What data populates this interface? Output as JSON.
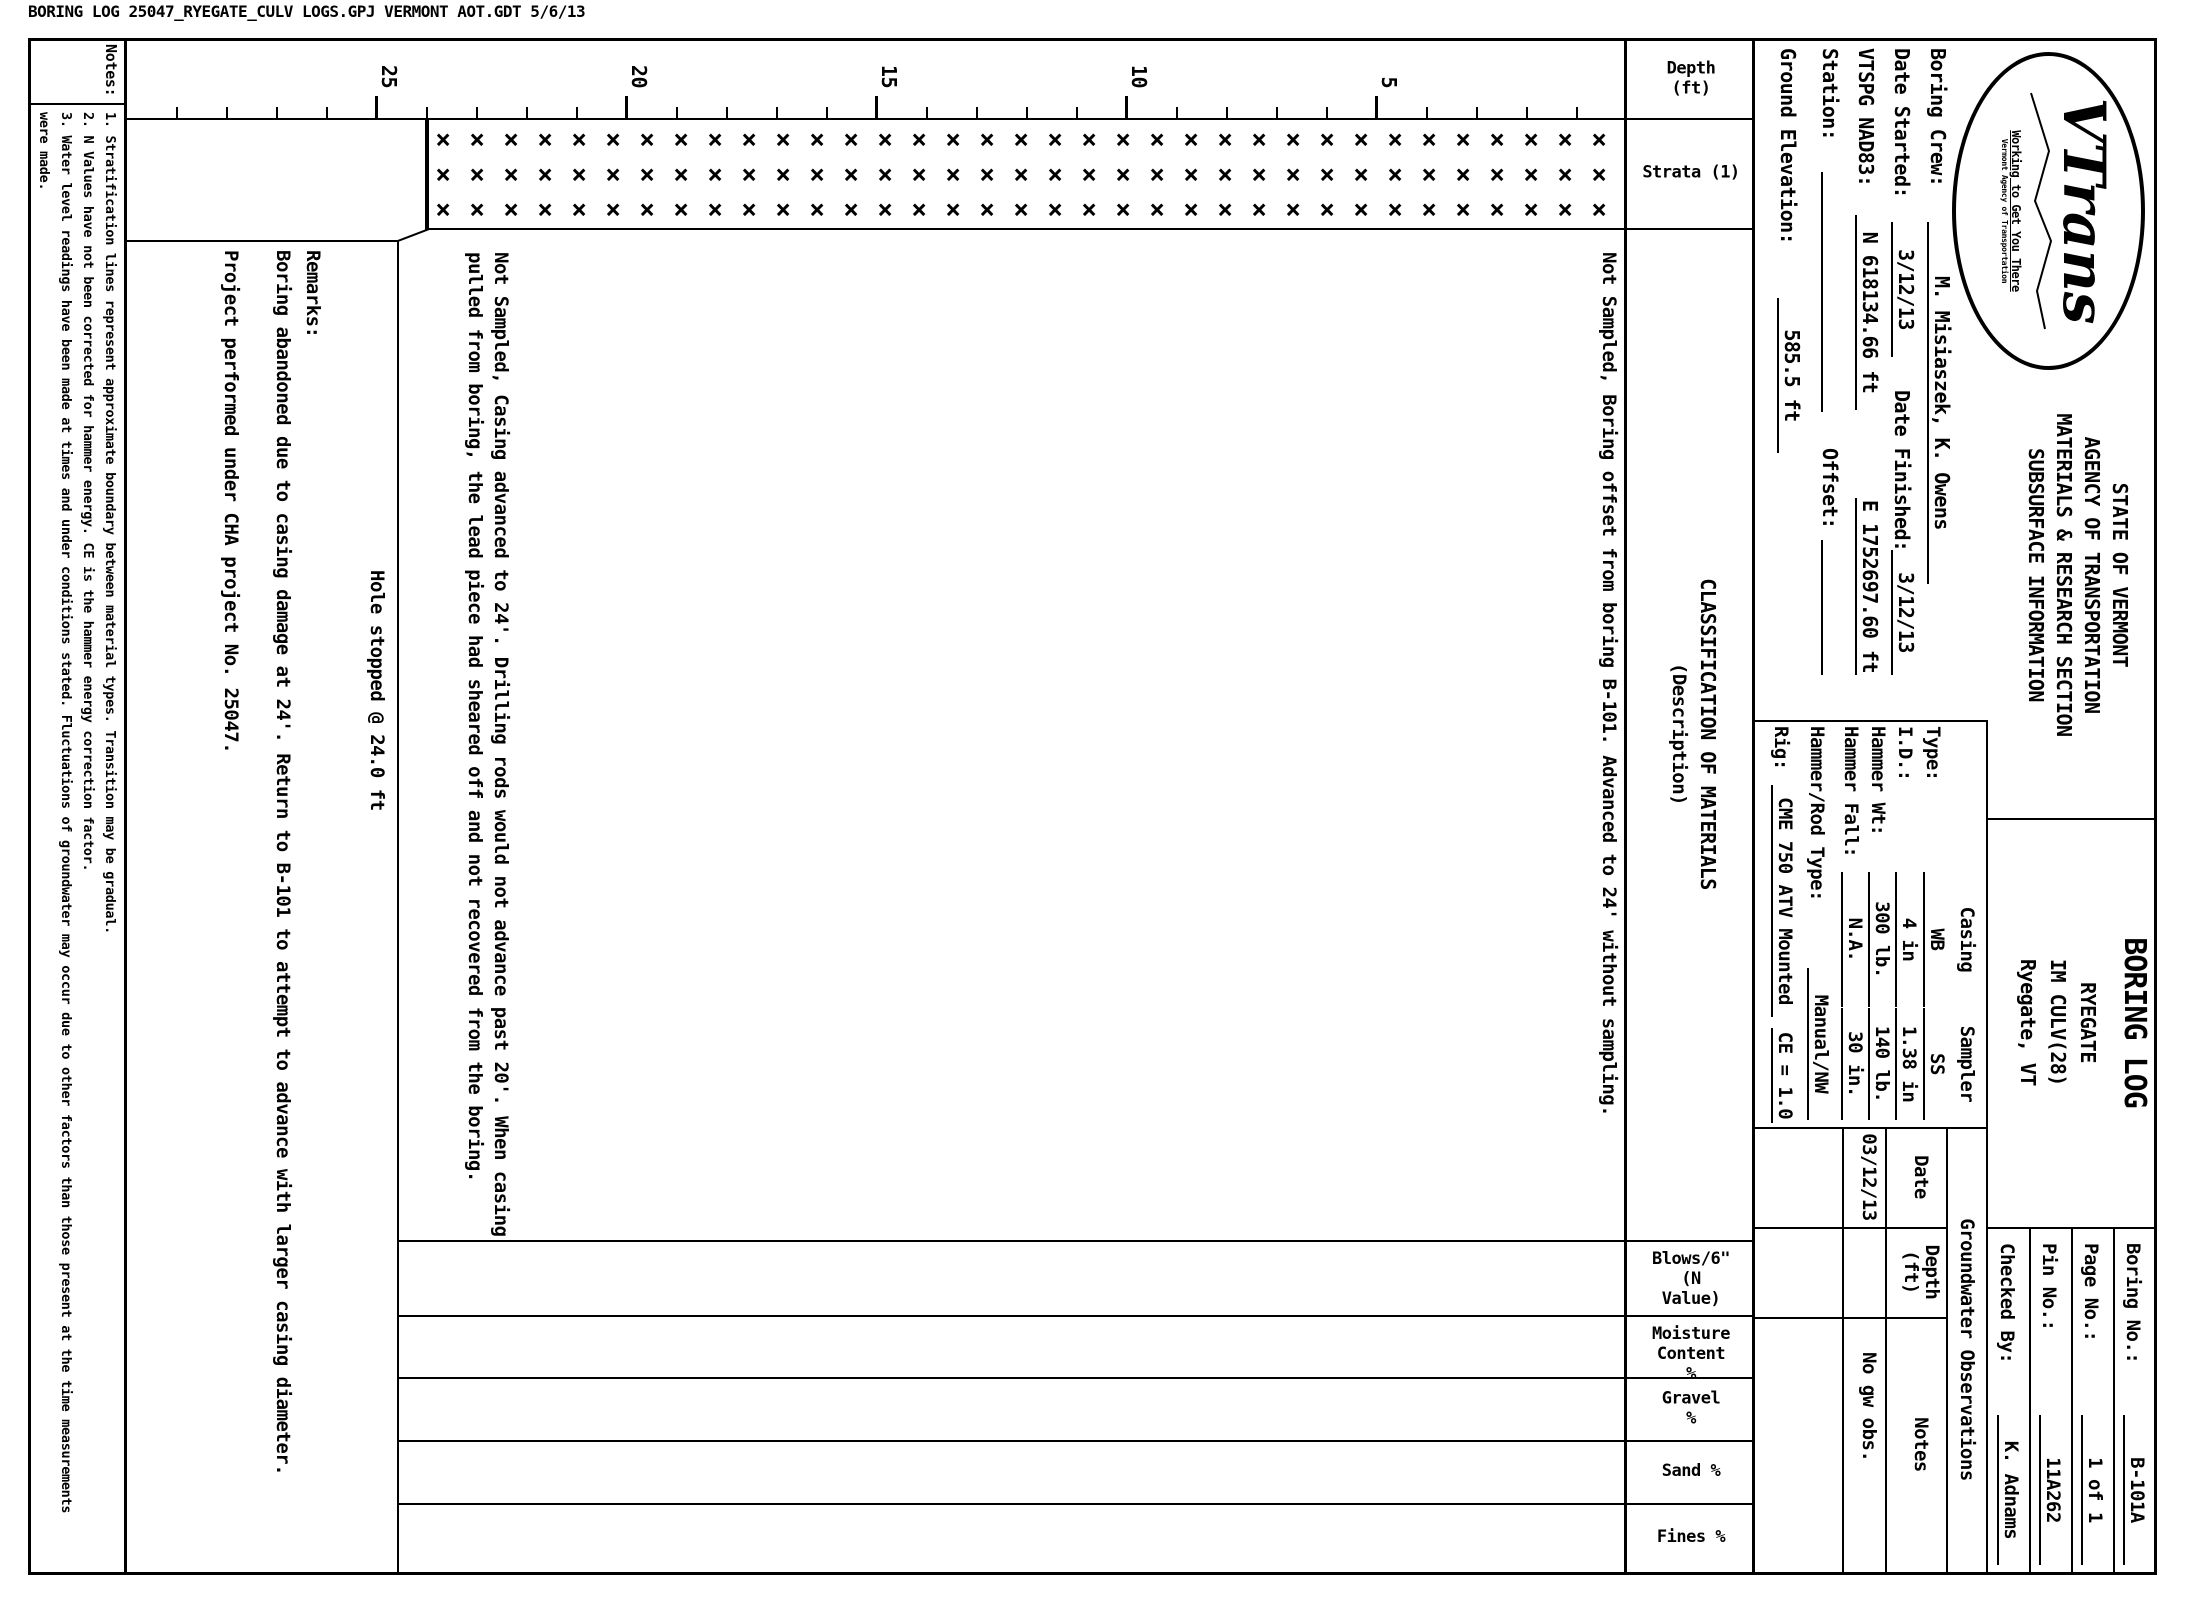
{
  "file_header": "BORING LOG   25047_RYEGATE_CULV LOGS.GPJ   VERMONT AOT.GDT   5/6/13",
  "header": {
    "logo": {
      "name": "VTrans",
      "tagline": "Working to Get You There",
      "subtext": "Vermont Agency of Transportation"
    },
    "agency_lines": [
      "STATE OF VERMONT",
      "AGENCY OF TRANSPORTATION",
      "MATERIALS & RESEARCH SECTION",
      "SUBSURFACE INFORMATION"
    ],
    "title": "BORING LOG",
    "project_lines": [
      "RYEGATE",
      "IM CULV(28)",
      "Ryegate, VT"
    ],
    "info_box": [
      {
        "label": "Boring No.:",
        "value": "B-101A"
      },
      {
        "label": "Page No.:",
        "value": "1 of 1"
      },
      {
        "label": "Pin No.:",
        "value": "11A262"
      },
      {
        "label": "Checked By:",
        "value": "K. Adnams"
      }
    ]
  },
  "fields": {
    "boring_crew": {
      "label": "Boring Crew:",
      "value": "M. Misiaszek, K. Owens"
    },
    "date_started": {
      "label": "Date Started:",
      "value": "3/12/13"
    },
    "date_finished": {
      "label": "Date Finished:",
      "value": "3/12/13"
    },
    "vtspg": {
      "label": "VTSPG NAD83:",
      "northing": "N 618134.66 ft",
      "easting": "E 1752697.60 ft"
    },
    "station": {
      "label": "Station:",
      "value": ""
    },
    "offset": {
      "label": "Offset:",
      "value": ""
    },
    "ground_elevation": {
      "label": "Ground Elevation:",
      "value": "585.5 ft"
    }
  },
  "casing_sampler": {
    "columns": [
      "Casing",
      "Sampler"
    ],
    "rows": [
      {
        "label": "Type:",
        "casing": "WB",
        "sampler": "SS"
      },
      {
        "label": "I.D.:",
        "casing": "4 in",
        "sampler": "1.38 in"
      },
      {
        "label": "Hammer Wt:",
        "casing": "300 lb.",
        "sampler": "140 lb."
      },
      {
        "label": "Hammer Fall:",
        "casing": "N.A.",
        "sampler": "30 in."
      }
    ],
    "hammer_rod": {
      "label": "Hammer/Rod Type:",
      "value": "Manual/NW"
    },
    "rig": {
      "label": "Rig:",
      "value": "CME 750 ATV Mounted",
      "ce": "CE = 1.0"
    }
  },
  "groundwater": {
    "title": "Groundwater Observations",
    "columns": [
      "Date",
      "Depth\n(ft)",
      "Notes"
    ],
    "rows": [
      {
        "date": "03/12/13",
        "depth": "",
        "notes": "No gw obs."
      }
    ]
  },
  "log": {
    "columns": [
      "Depth\n(ft)",
      "Strata (1)",
      "CLASSIFICATION OF MATERIALS",
      "(Description)",
      "Blows/6\"\n(N Value)",
      "Moisture\nContent %",
      "Gravel %",
      "Sand %",
      "Fines %"
    ],
    "depth_scale": {
      "unit": "ft",
      "px_per_ft": 50,
      "top_px": 573,
      "minor_every_ft": 1,
      "major_every_ft": 5,
      "labels": [
        5,
        10,
        15,
        20,
        25
      ],
      "max_ft": 29
    },
    "strata": {
      "symbol": "×",
      "cols_x": [
        132,
        167,
        202
      ],
      "top_px": 588,
      "bottom_px": 1760,
      "row_step_px": 34,
      "depth_range_ft": [
        0,
        24
      ]
    },
    "descriptions": [
      {
        "text": "Not Sampled, Boring offset from boring B-101.  Advanced to 24' without sampling."
      },
      {
        "text": "Not Sampled, Casing advanced to 24'.  Drilling rods would not advance past 20'.  When casing pulled from boring, the lead piece had sheared off and not recovered from the boring."
      }
    ],
    "hole_stopped": "Hole stopped @ 24.0 ft",
    "remarks": {
      "label": "Remarks:",
      "lines": [
        "Boring abandoned due to casing damage at 24'.  Return to B-101 to attempt to advance with larger casing diameter.",
        "Project performed under CHA project No. 25047."
      ]
    }
  },
  "notes": {
    "label": "Notes:",
    "lines": [
      "1. Stratification lines represent approximate boundary between material types. Transition may be gradual.",
      "2. N Values have not been corrected for hammer energy. CE is the hammer energy correction factor.",
      "3. Water level readings have been made at times and under conditions stated. Fluctuations of groundwater may occur due to other factors than those present at the time measurements",
      "were made."
    ]
  }
}
